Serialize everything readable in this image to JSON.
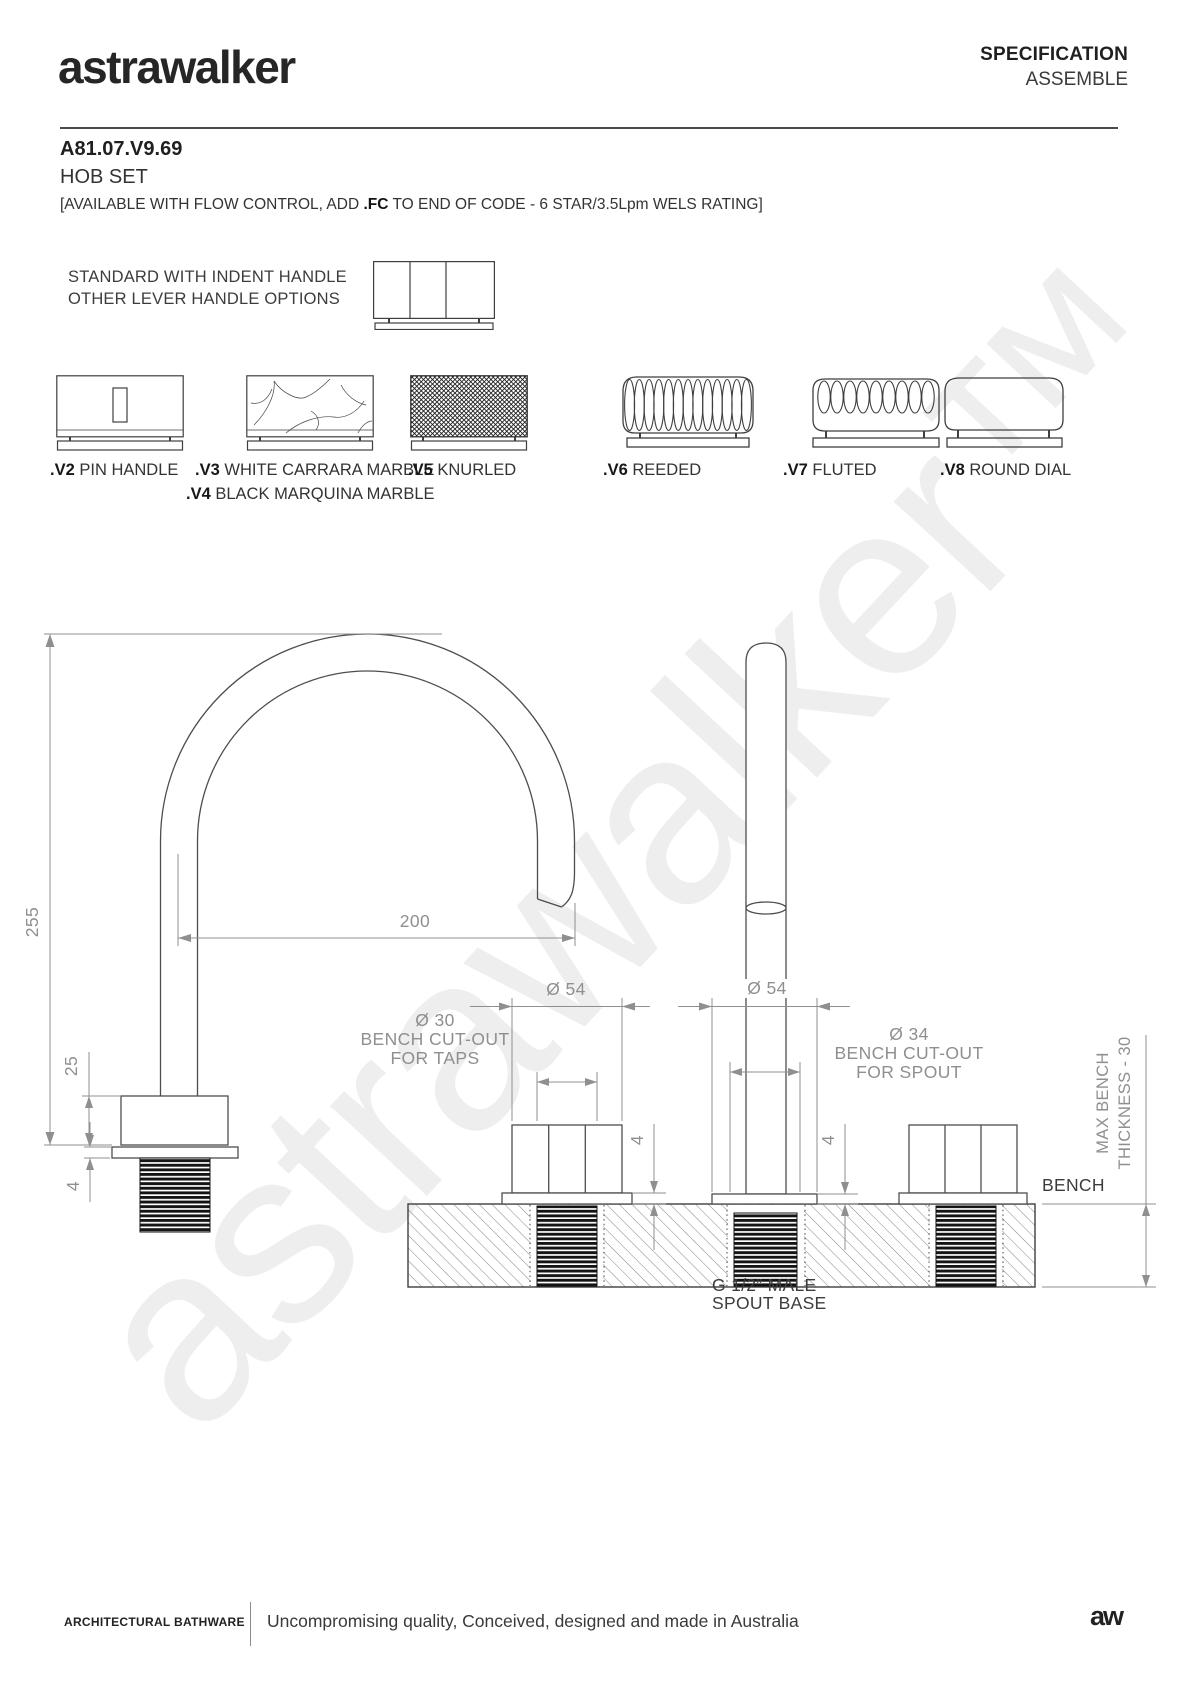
{
  "header": {
    "logo": "astrawalker",
    "doc_type": "SPECIFICATION",
    "doc_subtype": "ASSEMBLE"
  },
  "product": {
    "code": "A81.07.V9.69",
    "name": "HOB SET",
    "availability_prefix": "[AVAILABLE WITH FLOW CONTROL, ADD ",
    "availability_bold": ".FC",
    "availability_suffix": " TO END OF CODE - 6 STAR/3.5Lpm WELS RATING]"
  },
  "handles": {
    "intro_line1": "STANDARD WITH INDENT HANDLE",
    "intro_line2": "OTHER LEVER HANDLE OPTIONS",
    "options": [
      {
        "code": ".V2",
        "label": "PIN HANDLE"
      },
      {
        "code": ".V3",
        "label": "WHITE CARRARA MARBLE"
      },
      {
        "code": ".V4",
        "label": "BLACK MARQUINA MARBLE"
      },
      {
        "code": ".V5",
        "label": "KNURLED"
      },
      {
        "code": ".V6",
        "label": "REEDED"
      },
      {
        "code": ".V7",
        "label": "FLUTED"
      },
      {
        "code": ".V8",
        "label": "ROUND DIAL"
      }
    ]
  },
  "drawing": {
    "dims": {
      "spout_height": "255",
      "spout_reach": "200",
      "tap_body_height": "25",
      "tap_flange_height": "4",
      "tap_dia": "Ø 54",
      "spout_flange_dia": "Ø 54",
      "tap_cutout_dia": "Ø 30",
      "tap_cutout_line2": "BENCH CUT-OUT",
      "tap_cutout_line3": "FOR TAPS",
      "spout_cutout_dia": "Ø 34",
      "spout_cutout_line2": "BENCH CUT-OUT",
      "spout_cutout_line3": "FOR SPOUT",
      "tap_flange_front": "4",
      "spout_flange_front": "4",
      "bench_label": "BENCH",
      "max_bench_line1": "MAX BENCH",
      "max_bench_line2": "THICKNESS - 30",
      "spout_base_line1": "G 1/2” MALE",
      "spout_base_line2": "SPOUT BASE"
    }
  },
  "watermark": "astrawalker™",
  "footer": {
    "brand": "ARCHITECTURAL BATHWARE",
    "tagline": "Uncompromising quality, Conceived, designed and made in Australia",
    "logo_mark": "aw"
  }
}
